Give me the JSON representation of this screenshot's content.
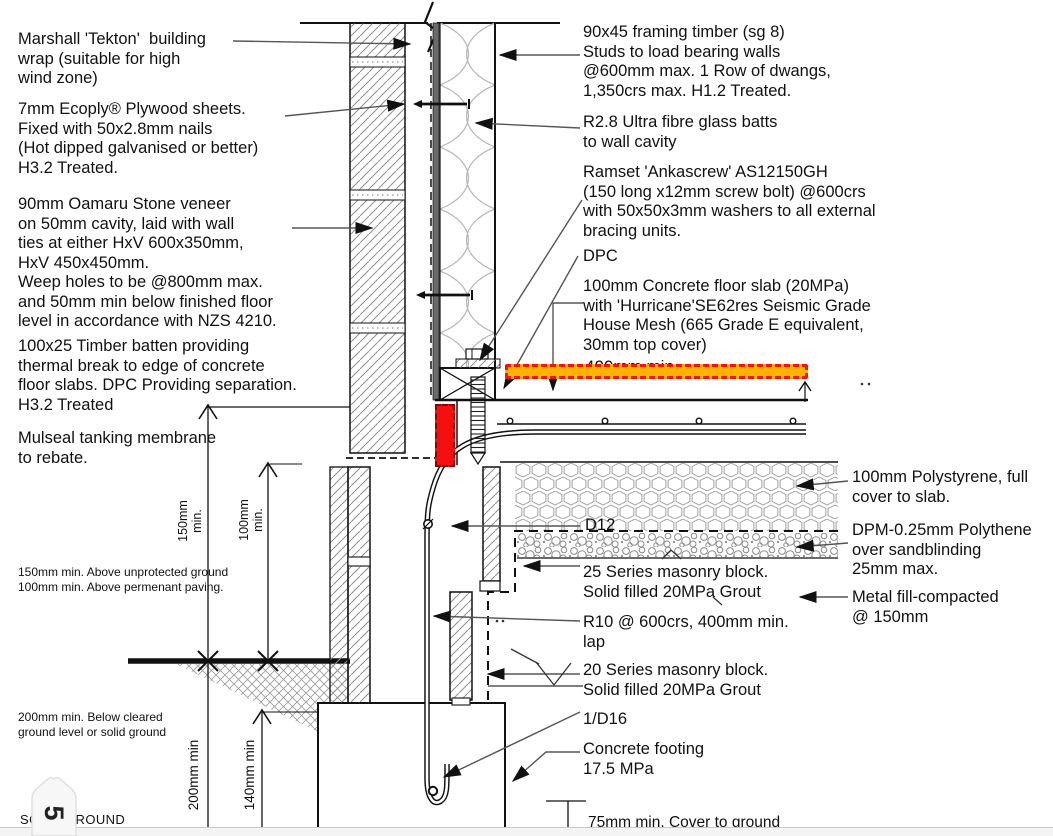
{
  "colors": {
    "highlight_red": "#f50f0f",
    "highlight_bar_fill": "#ffb300",
    "highlight_bar_border": "#f31313",
    "line": "#111111",
    "hatch_gray": "#8f8f8f"
  },
  "marker": {
    "label": "5"
  },
  "labels": {
    "marshall": "Marshall 'Tekton'  building\nwrap (suitable for high\nwind zone)",
    "ecoply": "7mm Ecoply® Plywood sheets.\nFixed with 50x2.8mm nails\n(Hot dipped galvanised or better)\nH3.2 Treated.",
    "oamaru": "90mm Oamaru Stone veneer\non 50mm cavity, laid with wall\nties at either HxV 600x350mm,\nHxV 450x450mm.\nWeep holes to be @800mm max.\nand 50mm min below finished floor\nlevel in accordance with NZS 4210.",
    "batten": "100x25 Timber batten providing\nthermal break to edge of concrete\nfloor slabs. DPC Providing separation.\nH3.2 Treated",
    "mulseal": "Mulseal tanking membrane\nto rebate.",
    "above_ground": "150mm min. Above unprotected ground\n100mm min. Above permenant paving.",
    "below_ground": "200mm min. Below cleared\nground level or solid ground",
    "solid_ground": "SOLID GROUND",
    "framing": "90x45 framing timber (sg 8)\nStuds to load bearing walls\n@600mm max. 1 Row of dwangs,\n1,350crs max. H1.2 Treated.",
    "batts": "R2.8 Ultra fibre glass batts\nto wall cavity",
    "ramset": "Ramset 'Ankascrew' AS12150GH\n(150 long x12mm screw bolt) @600crs\nwith 50x50x3mm washers to all external\nbracing units.",
    "dpc": "DPC",
    "slab": "100mm Concrete floor slab (20MPa)\nwith 'Hurricane'SE62res Seismic Grade\nHouse Mesh (665 Grade E equivalent,\n30mm top cover)",
    "hidden_dim": "400mm min",
    "d12": "D12",
    "series25": "25 Series masonry block.\nSolid filled 20MPa Grout",
    "r10": "R10 @ 600crs, 400mm min.\nlap",
    "series20": "20 Series masonry block.\nSolid filled 20MPa Grout",
    "d16": "1/D16",
    "footing": "Concrete footing\n17.5 MPa",
    "cover75": "75mm min. Cover to ground",
    "poly": "100mm Polystyrene, full\ncover to slab.",
    "dpm": "DPM-0.25mm Polythene\nover sandblinding\n25mm max.",
    "metal": "Metal fill-compacted\n@ 150mm"
  },
  "dims": {
    "d150": "150mm\nmin.",
    "d100": "100mm\nmin.",
    "d200": "200mm min",
    "d140": "140mm min"
  }
}
